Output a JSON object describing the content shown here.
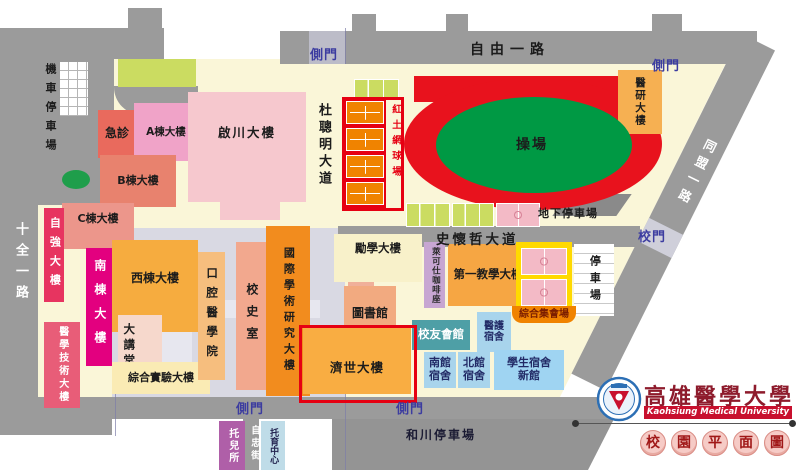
{
  "palette": {
    "campus_bg": "#faf6d8",
    "road_gray": "#9b9b9b",
    "gate_text_blue": "#3c3ca0",
    "track_red": "#e8121d",
    "field_green": "#009944",
    "court_green": "#cbdc61",
    "court_orange": "#f08300",
    "court_pink": "#f3bac6",
    "assembly_yellow": "#ffd900",
    "highlight_red": "#e60012",
    "logo_banner_red": "#c8102e",
    "logo_text_red": "#8e1b2c"
  },
  "roads": {
    "ziyou_1st_rd": "自由一路",
    "shiquan_1st_rd": "十全一路",
    "tongmeng_1st_rd": "同盟一路",
    "ducongming_ave": "杜聰明大道",
    "shihuaizhe_ave": "史懷哲大道",
    "zizhong_st": "自忠街"
  },
  "gates": {
    "side_gate": "側門",
    "main_gate": "校門"
  },
  "areas": {
    "track": "操場",
    "clay_tennis": "紅土網球場",
    "underground_parking": "地下停車場",
    "motorcycle_parking": "機車停車場",
    "parking": "停車場",
    "hechuan_parking": "和川停車場"
  },
  "buildings": {
    "emergency": "急診",
    "building_a": "A棟大樓",
    "building_b": "B棟大樓",
    "building_c": "C棟大樓",
    "qichuan": "啟川大樓",
    "ziqiang": "自強大樓",
    "south_wing": "南棟大樓",
    "med_tech": "醫學技術大樓",
    "west_wing": "西棟大樓",
    "auditorium": "大講堂",
    "integrated_lab": "綜合實驗大樓",
    "dental_college": "口腔醫學院",
    "history_room": "校史室",
    "intl_research": "國際學術研究大樓",
    "lixue": "勵學大樓",
    "library": "圖書館",
    "jishi": "濟世大樓",
    "med_research": "醫研大樓",
    "cafe": "萊可仕咖啡座",
    "first_teaching": "第一教學大樓",
    "assembly_hall": "綜合集會場",
    "alumni_house": "校友會館",
    "nurse_dorm": "醫護宿舍",
    "south_dorm": "南館宿舍",
    "north_dorm": "北館宿舍",
    "new_student_dorm": "學生宿舍新館",
    "nursery": "托兒所",
    "childcare_center": "托育中心"
  },
  "legend": {
    "university_zh": "高雄醫學大學",
    "university_en": "Kaohsiung Medical University",
    "map_title_chars": [
      "校",
      "園",
      "平",
      "面",
      "圖"
    ]
  }
}
